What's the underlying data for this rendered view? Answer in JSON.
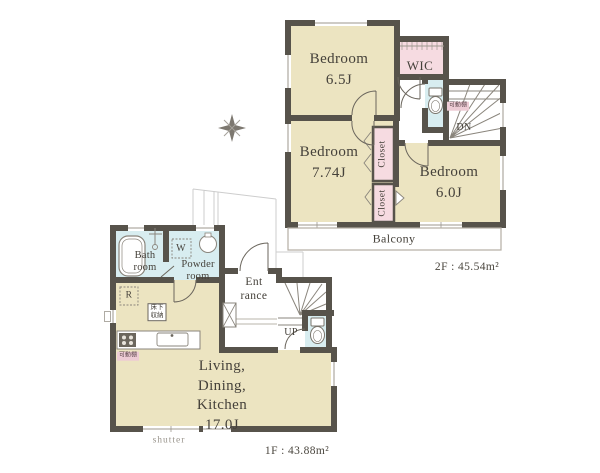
{
  "f2": {
    "bed1": {
      "name": "Bedroom",
      "size": "6.5J"
    },
    "bed2": {
      "name": "Bedroom",
      "size": "7.74J"
    },
    "bed3": {
      "name": "Bedroom",
      "size": "6.0J"
    },
    "wic": "WIC",
    "closet_upper": "Closet",
    "closet_lower": "Closet",
    "shelf": "可動棚",
    "down": "DN",
    "balcony": "Balcony",
    "area": "2F : 45.54m²"
  },
  "f1": {
    "ldk": {
      "line1": "Living,",
      "line2": "Dining,",
      "line3": "Kitchen",
      "size": "17.0J"
    },
    "bath": {
      "line1": "Bath",
      "line2": "room"
    },
    "powder": {
      "line1": "Powder",
      "line2": "room"
    },
    "entrance": {
      "line1": "Ent",
      "line2": "rance"
    },
    "washer": "W",
    "fridge": "R",
    "floor_storage": {
      "line1": "床下",
      "line2": "収納"
    },
    "shelf": "可動棚",
    "up": "UP",
    "shutter": "shutter",
    "area": "1F : 43.88m²"
  },
  "colors": {
    "wall": "#57534b",
    "room_beige": "#ece4c1",
    "closet_pink": "#f6dbe1",
    "wet_blue": "#d8edf0",
    "tag_pink": "#edcbd4",
    "text": "#45413a"
  }
}
